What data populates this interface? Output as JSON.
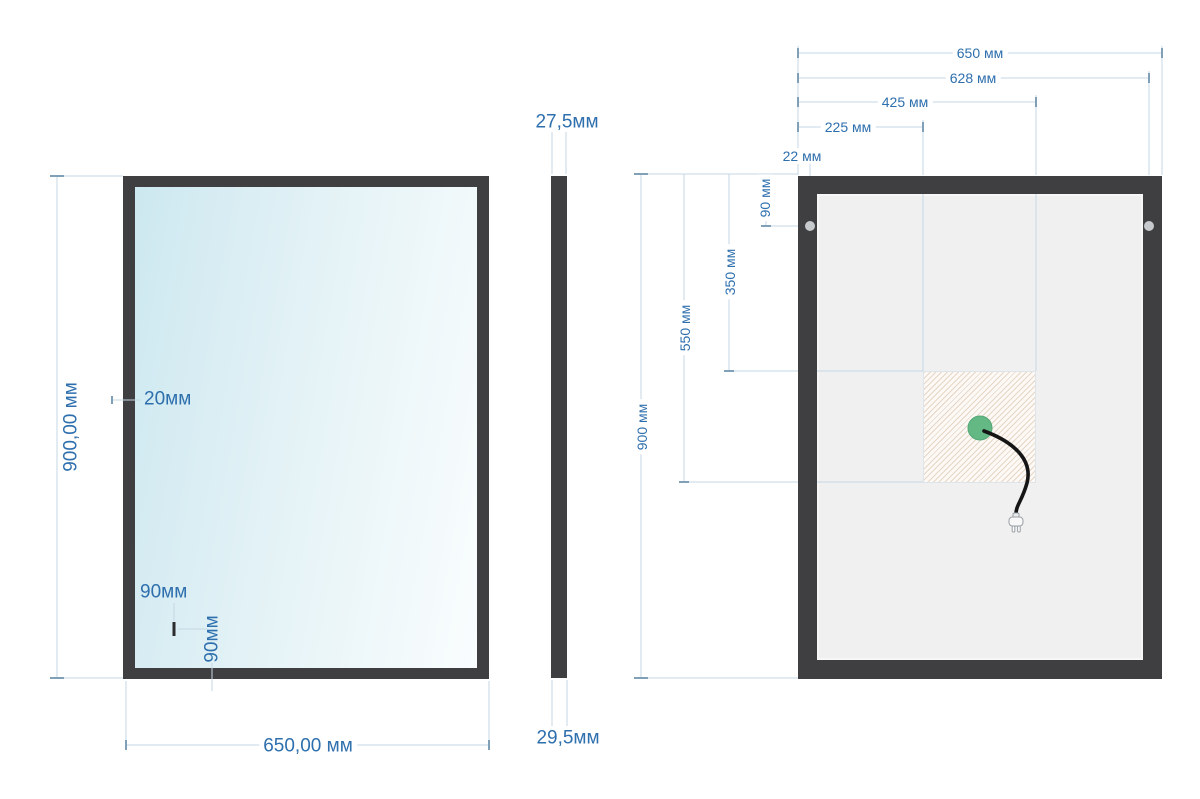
{
  "drawing": {
    "title": "mirror-technical-drawing",
    "views": {
      "front": {
        "dims": {
          "height": "900,00 мм",
          "width": "650,00 мм",
          "frame_width": "20мм",
          "sensor_from_left": "90мм",
          "sensor_from_bottom": "90мм"
        }
      },
      "side": {
        "dims": {
          "top_depth": "27,5мм",
          "bottom_depth": "29,5мм"
        }
      },
      "back": {
        "dims": {
          "width": "650 мм",
          "holes_span": "628 мм",
          "socket_zone_right": "425 мм",
          "socket_zone_left": "225 мм",
          "hole_inset": "22 мм",
          "hole_from_top": "90 мм",
          "socket_zone_top": "350 мм",
          "socket_zone_bottom": "550 мм",
          "height": "900 мм"
        }
      }
    },
    "icons": {
      "power_plug_icon": "two-prong-plug",
      "power_cable": "curved-black-cable",
      "connection_point": "green-circle"
    },
    "colors": {
      "dimension_text": "#2e6fad",
      "dimension_line": "#c6d7e4",
      "dimension_tick": "#7fa0b6",
      "frame": "#3f3f41",
      "mirror_gradient_start": "#cde8f0",
      "mirror_gradient_end": "#fafdfe",
      "back_panel": "#f0f0f0",
      "hatch_line": "#dec0a2",
      "connection_point_green": "#63b883",
      "cable_black": "#151515",
      "mount_hole_gray": "#c6cacd"
    }
  }
}
